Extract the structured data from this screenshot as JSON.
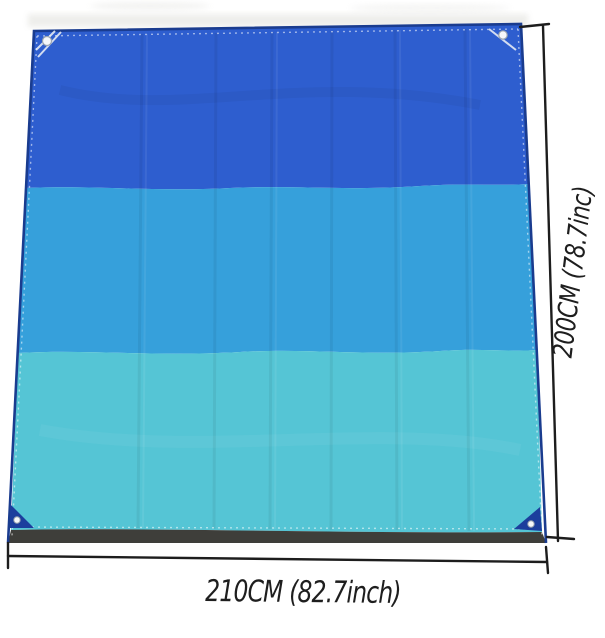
{
  "image": {
    "description": "Product photo of a folded-crease waterproof beach blanket / tarp with three horizontal color stripes, corner grommets and hand-drawn dimension annotations on white background",
    "annotations": {
      "width_label": "210CM (82.7inch)",
      "height_label": "200CM (78.7inc)"
    },
    "colors": {
      "background": "#ffffff",
      "stripe_top": "#2e5ecf",
      "stripe_middle": "#36a0db",
      "stripe_bottom": "#55c5d5",
      "hem_navy": "#1a3c8f",
      "corner_patch_navy": "#1c3e9d",
      "bottom_edge_gray": "#3e3e3a",
      "annotation_ink": "#1d1d1d",
      "stitch_white": "#f4f7fa",
      "grommet_ring": "#9aa4b0"
    },
    "features": {
      "stripe_count": 3,
      "grommet_corners": [
        "top-left",
        "top-right",
        "bottom-left",
        "bottom-right"
      ]
    }
  }
}
